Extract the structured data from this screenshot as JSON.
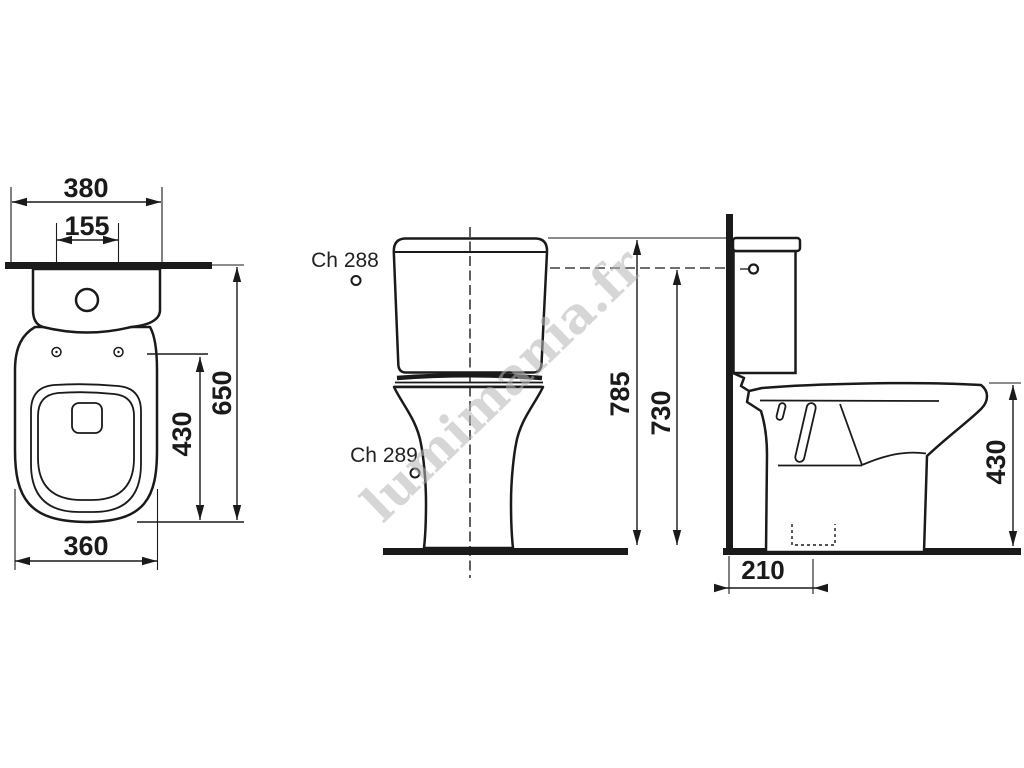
{
  "watermark": {
    "text": "lumimania.fr"
  },
  "views": {
    "top": {
      "dims": {
        "overall_width": "380",
        "hinge_spacing": "155",
        "overall_depth": "650",
        "lid_depth": "430",
        "bowl_width": "360"
      }
    },
    "front": {
      "labels": {
        "ch288": "Ch 288",
        "ch289": "Ch 289"
      },
      "dims": {
        "overall_height": "785",
        "lever_height": "730"
      }
    },
    "side": {
      "dims": {
        "rim_height": "430",
        "outlet_offset": "210"
      }
    }
  },
  "colors": {
    "line": "#1a1a1a",
    "watermark": "#b5b5b5",
    "background": "#ffffff"
  }
}
